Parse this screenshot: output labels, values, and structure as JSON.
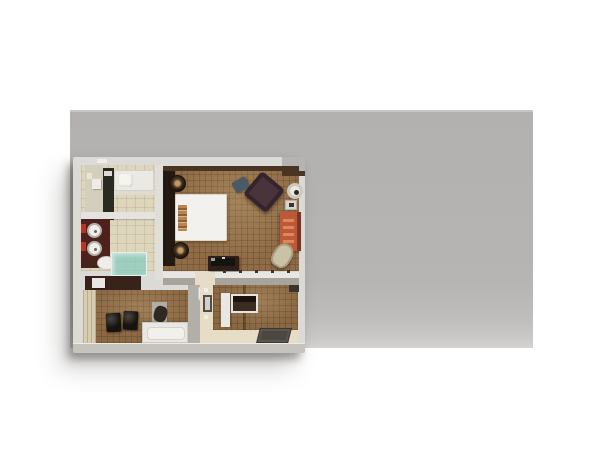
{
  "scene": {
    "type": "3d-floorplan-render",
    "subject": "top-down cutaway rendering of a hotel suite on a gray backdrop",
    "rooms": [
      "bathroom",
      "bedroom",
      "closet-dressing-area",
      "entry-foyer"
    ],
    "bathroom_items": [
      "bathtub",
      "double-sink-vanity",
      "toilet",
      "glass-shower"
    ],
    "bedroom_items": [
      "king-bed",
      "nightstand-lamps",
      "armchair",
      "side-table",
      "armoire",
      "lounge-chair",
      "tv-console"
    ],
    "closet_items": [
      "closet-wall",
      "two-black-ottomans",
      "minibar-cabinet",
      "desk-chair"
    ],
    "entry_items": [
      "console-table",
      "wall-mirror",
      "doormat"
    ]
  },
  "colors": {
    "page_bg": "#ffffff",
    "backdrop": "#b6b4b2",
    "wall_light": "#dcdad6",
    "wall_bottom": "#c6c3be",
    "bath_tile": "#ddd5bc",
    "bath_dark_wall": "#2b2a22",
    "tub_white": "#ebe9e3",
    "vanity_mahogany": "#4e211c",
    "sink_white": "#efede9",
    "towel_red": "#b53527",
    "shower_glass": "#8fccbe",
    "toilet_white": "#f0eee9",
    "bedroom_carpet": "#8f6c46",
    "headboard_dark": "#221a12",
    "bed_white": "#f3f1ed",
    "pillow_tan": "#b9854c",
    "nightstand_brown": "#3a2718",
    "lamp_bronze": "#c79a5a",
    "armchair_plum": "#4a343c",
    "ottoman_slate": "#4b5a67",
    "side_table_white": "#ece8e2",
    "armoire_orange": "#bf5837",
    "armoire_slat": "#d8895a",
    "lounge_beige": "#cbc1a6",
    "tv_console_brown": "#2e2018",
    "closet_wall_beige": "#d6cdb0",
    "ottoman_black": "#17130f",
    "cabinet_white": "#e9e7e3",
    "entry_floor_cream": "#e7dcc6",
    "entry_carpet": "#8a6844",
    "doormat_gray": "#4c4741",
    "shelf_brown": "#38231a",
    "divider_gray": "#b2aea8"
  }
}
